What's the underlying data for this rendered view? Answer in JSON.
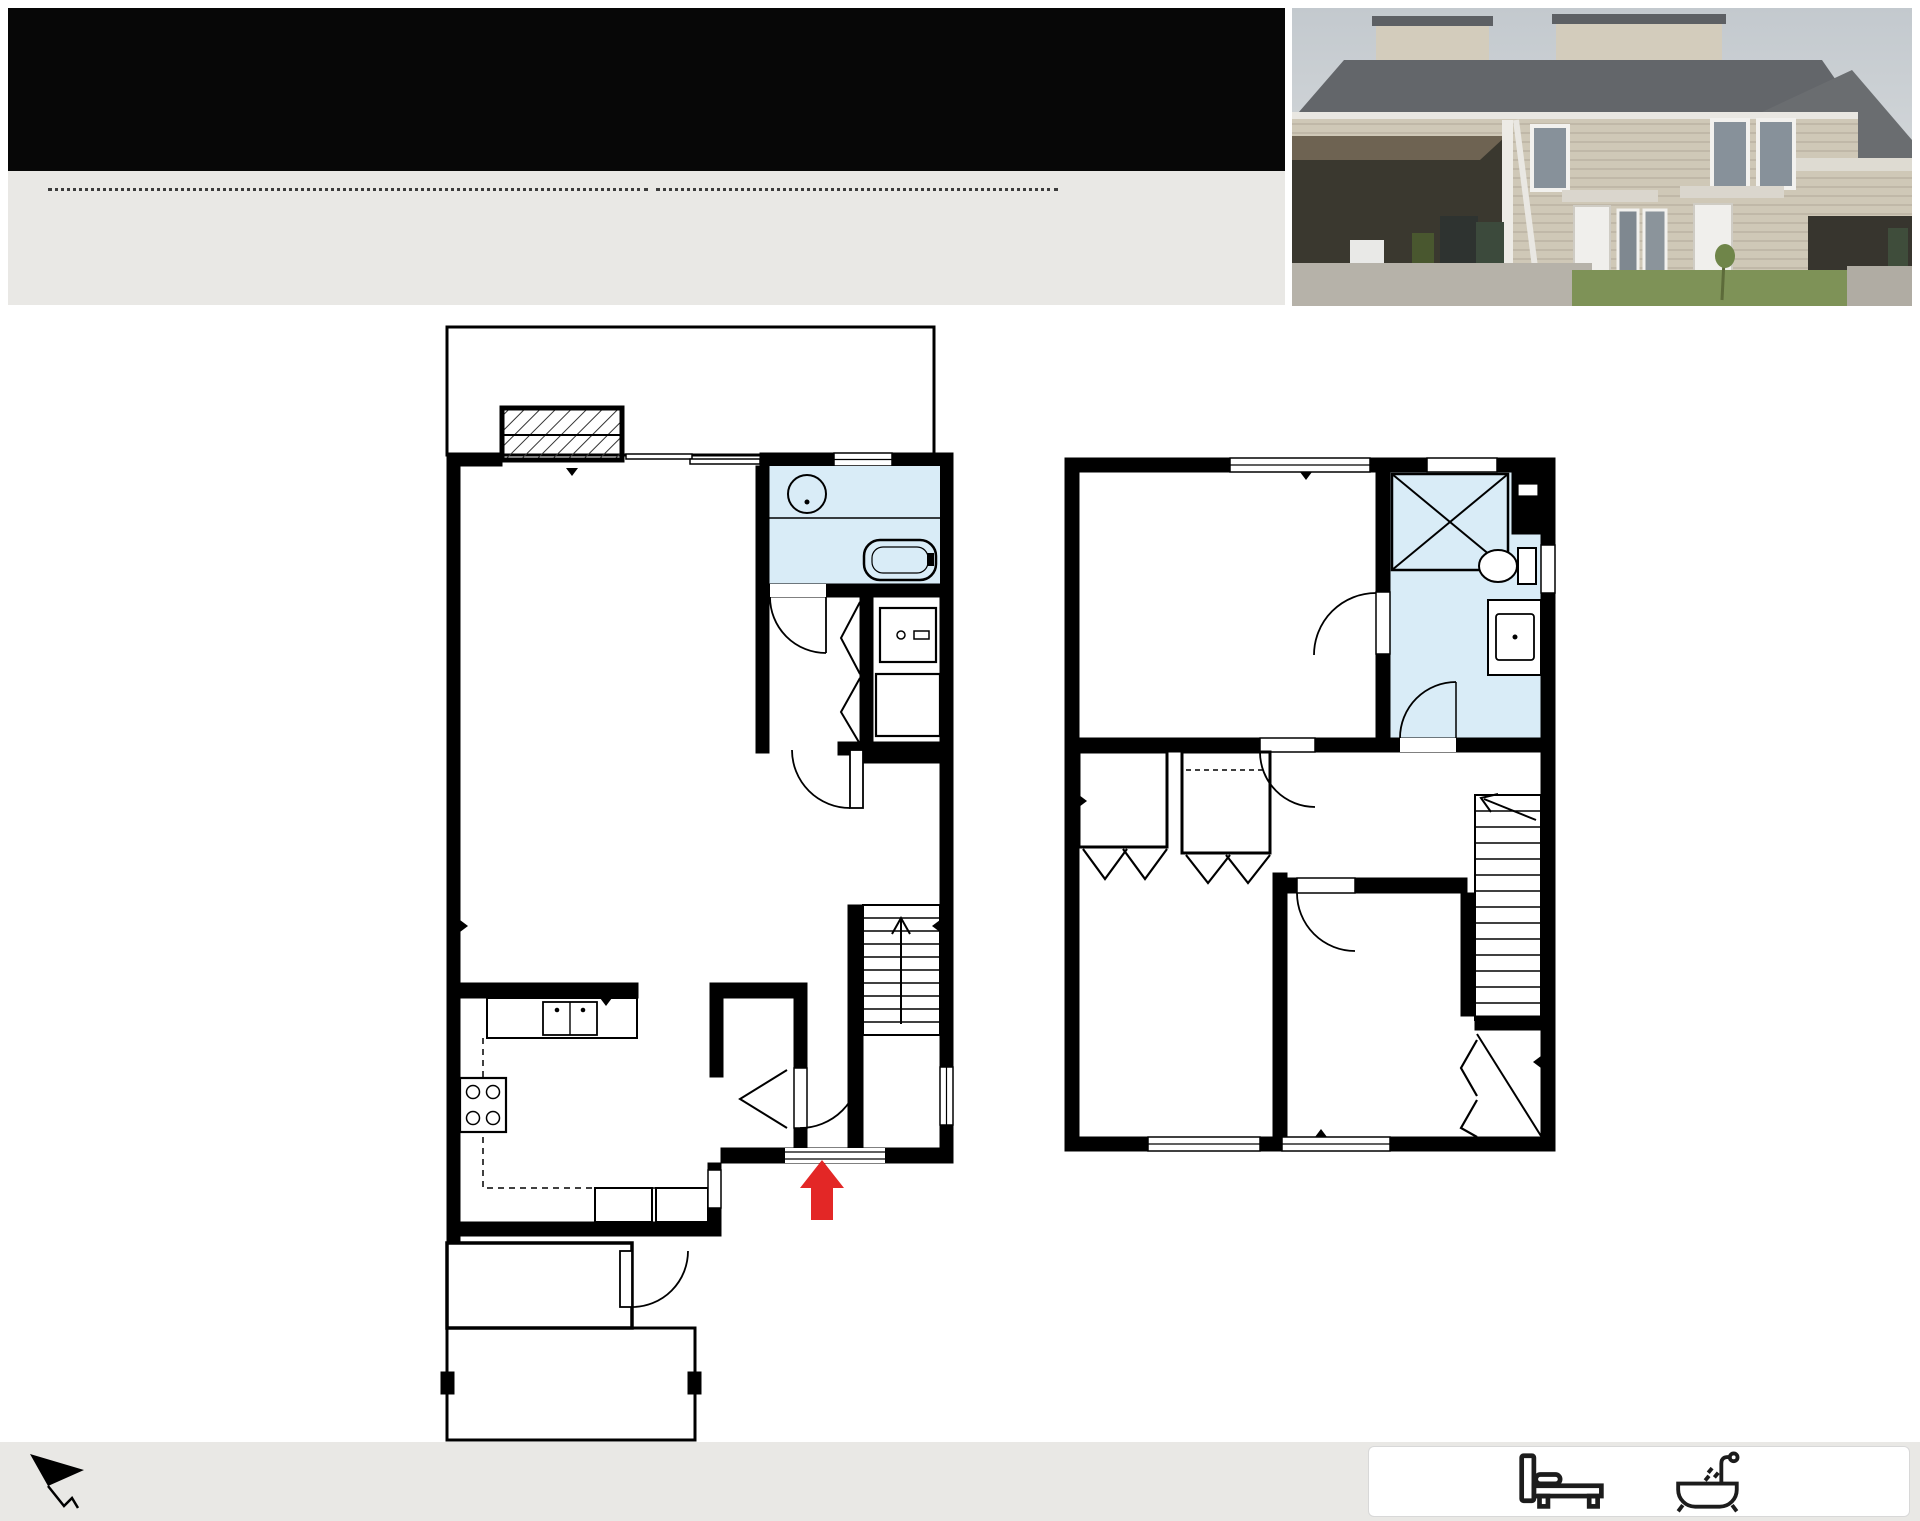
{
  "header": {
    "title": "177 - 32550 Maclure Rd, Abbotsford"
  },
  "summary": {
    "total_living": "TOTAL LIVING*: 1203 SQFT",
    "floor1": "FLOOR 1: 630 SQFT",
    "floor2": "FLOOR 2: 573 SQFT",
    "excluded_title": "EXCLUDED AREAS:",
    "patio": "PATIO*: 300 SQFT",
    "carport": "CARPORT: 175 SQFT",
    "storage": "STORAGE: 19 SQFT"
  },
  "floor1": {
    "label": "FLOOR 1",
    "rooms": {
      "patio": {
        "name": "Patio",
        "dims": "16'1\" x 19'5\""
      },
      "living": {
        "name": "Living Room",
        "dims": "12'5\" x 11'2\""
      },
      "bath": {
        "name": "Bath",
        "dims": "6'2\" x 5'2\""
      },
      "wd": {
        "label": "W.D"
      },
      "dining": {
        "name": "Dining Area",
        "dims": "16'2\" x 15'5\""
      },
      "kitchen": {
        "name": "Kitchen",
        "dims": "10'0\" x 10'3\""
      },
      "foyer": {
        "name": "Foyer",
        "dims": "6'2\" x 6'4\""
      },
      "storage": {
        "name": "Storage",
        "dims": "7'2\" x 2'8\""
      },
      "carport": {
        "name": "Extended Carport",
        "dims": "10'3\" x 19'4\""
      }
    }
  },
  "floor2": {
    "label": "FLOOR 2",
    "rooms": {
      "primary": {
        "name": "Primary Bedroom",
        "dims": "12'11\" x 10'10\""
      },
      "bath": {
        "name": "Bath",
        "dims": "5'9\" x 10'10\""
      },
      "hall": {
        "name": "Hall",
        "dims": "8'4\" x 5'5\""
      },
      "bedroom_left": {
        "name": "Bedroom",
        "dims": "7'10\" x 13'8\""
      },
      "bedroom_right": {
        "name": "Bedroom",
        "dims": "8'6\" x 10'3\""
      }
    }
  },
  "footer": {
    "line1": "E&O Insured. Sizes and dimensions are approximate, actual may vary. This floorplan is not suitable for architectural/construction.",
    "line2": "Total SQFT calculated to gross unit area. All details, sizes & placements should be considered as approximate within +/- 3% tolerance.",
    "badge": {
      "beds": "3 Beds",
      "baths": "2 Baths"
    }
  },
  "colors": {
    "wall": "#000000",
    "bath_fill": "#d9ecf7",
    "arrow_red": "#e32726",
    "header_bg": "#070707",
    "panel_bg": "#e9e8e5"
  }
}
